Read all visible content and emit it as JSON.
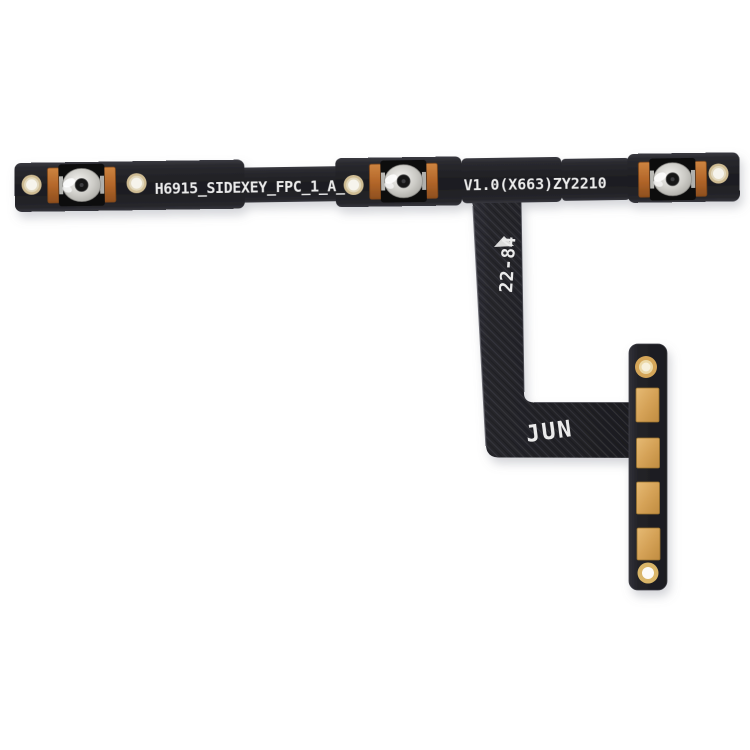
{
  "cable": {
    "markings": {
      "part_number": "H6915_SIDEXEY_FPC_1_A_",
      "version_code": "V1.0(X663)ZY2210",
      "date_code": "22-84",
      "month_code": "JUN"
    },
    "component_counts": {
      "tactile_switches": 3,
      "strip_alignment_holes": 4,
      "connector_pads": 4,
      "connector_ring_holes": 2
    },
    "colors": {
      "background": "#ffffff",
      "cable_body_black": "#222226",
      "ribbon_highlight": "#5a5a62",
      "copper_solder_tab": "#b4672a",
      "gold_contact_pad": "#d5a257",
      "switch_dome_silver": "#cccbc6",
      "switch_center_black": "#161616",
      "hole_ring_gold": "#cfbc93",
      "hole_center_white": "#f6f4ec",
      "silkscreen_white": "#ebebeb"
    }
  }
}
